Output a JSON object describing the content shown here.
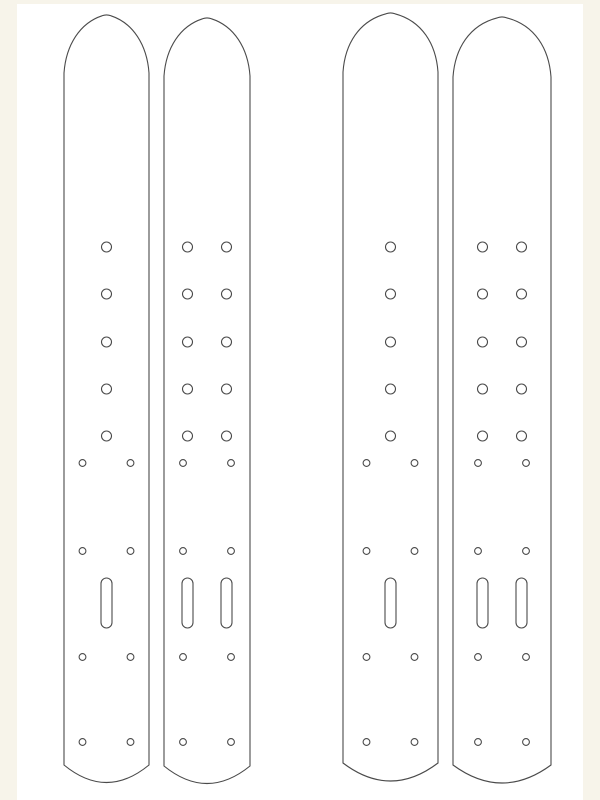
{
  "colors": {
    "page_background": "#f7f4ea",
    "sheet_background": "#ffffff",
    "line": "#4a4a4a",
    "strap_fill": "#ffffff"
  },
  "stroke_width": 1.1,
  "sheet": {
    "x": 17,
    "y": 4,
    "width": 566,
    "height": 796
  },
  "hole_rows": {
    "big_y": [
      247,
      294,
      342,
      389,
      436
    ],
    "small_y": [
      463,
      551,
      657,
      742
    ],
    "slot_y": 603
  },
  "hole_sizes": {
    "big_r": 5,
    "small_r": 3.4,
    "slot_w": 11,
    "slot_h": 50
  },
  "straps": [
    {
      "name": "strap-1",
      "left": 64,
      "right": 149,
      "tip_y": 14,
      "shoulder_y": 73,
      "bottom_corner_y": 765,
      "bottom_control_y": 800,
      "big_cx": [
        106.5
      ],
      "small_cx": [
        82.5,
        130.5
      ],
      "slot_cx": [
        106.5
      ]
    },
    {
      "name": "strap-2",
      "left": 164,
      "right": 250,
      "tip_y": 17,
      "shoulder_y": 76,
      "bottom_corner_y": 766,
      "bottom_control_y": 801,
      "big_cx": [
        187.5,
        226.5
      ],
      "small_cx": [
        183,
        231
      ],
      "slot_cx": [
        187.5,
        226.5
      ]
    },
    {
      "name": "strap-3",
      "left": 343,
      "right": 438,
      "tip_y": 12,
      "shoulder_y": 72,
      "bottom_corner_y": 763,
      "bottom_control_y": 799,
      "big_cx": [
        390.5
      ],
      "small_cx": [
        366.5,
        414.5
      ],
      "slot_cx": [
        390.5
      ]
    },
    {
      "name": "strap-4",
      "left": 453,
      "right": 551,
      "tip_y": 16,
      "shoulder_y": 77,
      "bottom_corner_y": 765,
      "bottom_control_y": 801,
      "big_cx": [
        482.5,
        521.5
      ],
      "small_cx": [
        478,
        526
      ],
      "slot_cx": [
        482.5,
        521.5
      ]
    }
  ]
}
